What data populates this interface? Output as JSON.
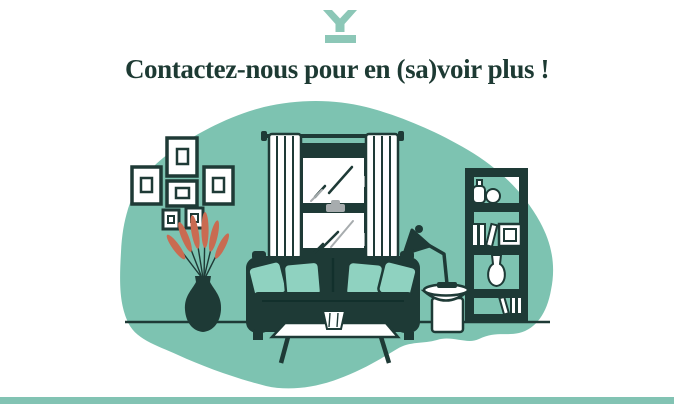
{
  "header": {
    "logo_icon": "y-mark-logo",
    "heading": "Contactez-nous pour en (sa)voir plus !"
  },
  "illustration": {
    "scene": "living-room",
    "elements": [
      "gallery-wall-frames",
      "potted-plant-with-coral-leaves",
      "curtained-window-with-glass-reflections",
      "dark-sofa-with-four-teal-cushions",
      "white-coffee-table-with-vase",
      "round-side-table",
      "desk-lamp",
      "bookshelf-with-books-vases-and-frame"
    ]
  },
  "colors": {
    "blob_teal": "#7dc3b1",
    "cushion_teal": "#8fd2c0",
    "ink_dark": "#1e3a36",
    "heading_text": "#1d3a33",
    "coral_leaves": "#c96b51",
    "logo_teal": "#8cc7b7",
    "footer_bar": "#82c3b3",
    "glass_gray": "#a7acae"
  }
}
